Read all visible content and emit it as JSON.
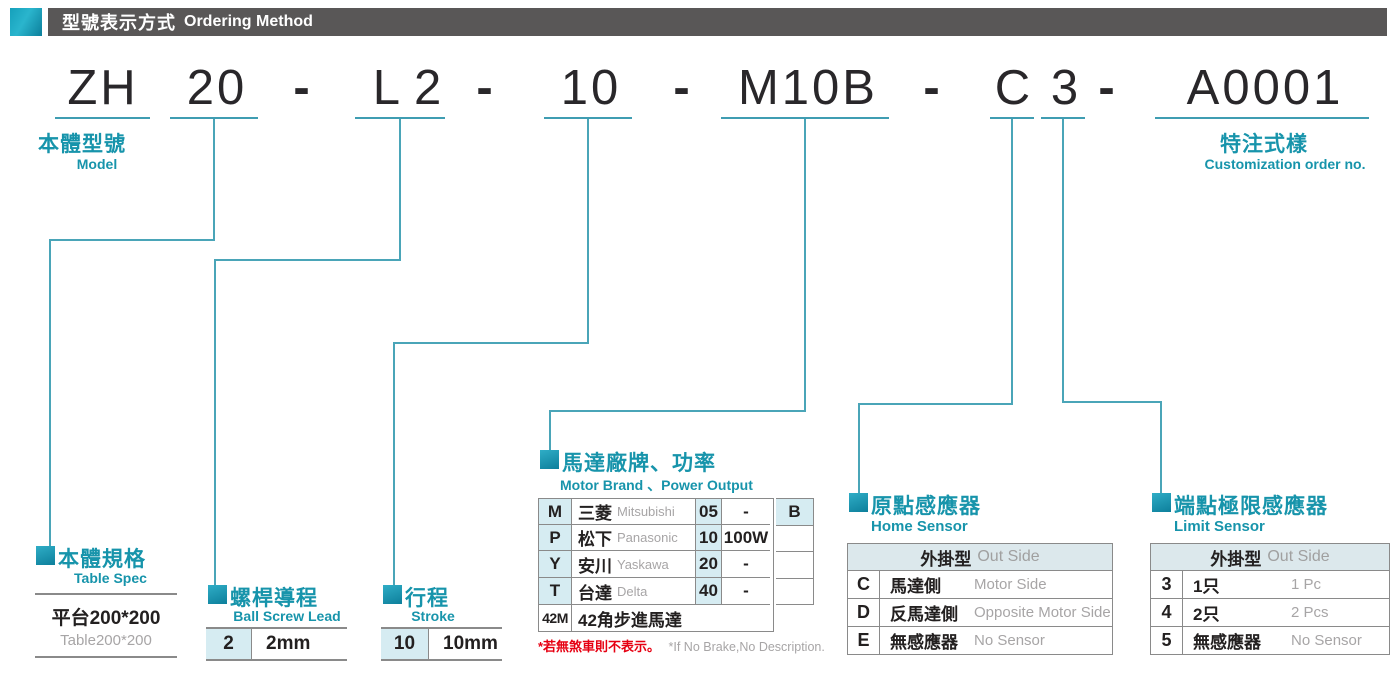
{
  "header": {
    "title_zh": "型號表示方式",
    "title_en": "Ordering Method"
  },
  "model": {
    "parts": [
      "ZH",
      "20",
      "-",
      "L2",
      "-",
      "10",
      "-",
      "M10B",
      "-",
      "C",
      "3",
      "-",
      "A0001"
    ]
  },
  "labels": {
    "model_zh": "本體型號",
    "model_en": "Model",
    "custom_zh": "特注式樣",
    "custom_en": "Customization order no."
  },
  "sections": {
    "table_spec": {
      "title_zh": "本體規格",
      "title_en": "Table Spec",
      "row_zh": "平台200*200",
      "row_en": "Table200*200"
    },
    "ball_screw": {
      "title_zh": "螺桿導程",
      "title_en": "Ball Screw Lead",
      "code": "2",
      "value": "2mm"
    },
    "stroke": {
      "title_zh": "行程",
      "title_en": "Stroke",
      "code": "10",
      "value": "10mm"
    },
    "motor": {
      "title_zh": "馬達廠牌、功率",
      "title_en": "Motor Brand 、Power Output",
      "rows": [
        {
          "code": "M",
          "brand_zh": "三菱",
          "brand_en": "Mitsubishi",
          "power_code": "05",
          "power": "-"
        },
        {
          "code": "P",
          "brand_zh": "松下",
          "brand_en": "Panasonic",
          "power_code": "10",
          "power": "100W"
        },
        {
          "code": "Y",
          "brand_zh": "安川",
          "brand_en": "Yaskawa",
          "power_code": "20",
          "power": "-"
        },
        {
          "code": "T",
          "brand_zh": "台達",
          "brand_en": "Delta",
          "power_code": "40",
          "power": "-"
        }
      ],
      "suffix": "B",
      "stepper": {
        "code": "42M",
        "label": "42角步進馬達"
      },
      "footnote_zh": "*若無煞車則不表示。",
      "footnote_en": "*If No Brake,No Description."
    },
    "home_sensor": {
      "title_zh": "原點感應器",
      "title_en": "Home Sensor",
      "header_zh": "外掛型",
      "header_en": "Out Side",
      "rows": [
        {
          "code": "C",
          "zh": "馬達側",
          "en": "Motor Side"
        },
        {
          "code": "D",
          "zh": "反馬達側",
          "en": "Opposite Motor Side"
        },
        {
          "code": "E",
          "zh": "無感應器",
          "en": "No Sensor"
        }
      ]
    },
    "limit_sensor": {
      "title_zh": "端點極限感應器",
      "title_en": "Limit Sensor",
      "header_zh": "外掛型",
      "header_en": "Out Side",
      "rows": [
        {
          "code": "3",
          "zh": "1只",
          "en": "1 Pc"
        },
        {
          "code": "4",
          "zh": "2只",
          "en": "2 Pcs"
        },
        {
          "code": "5",
          "zh": "無感應器",
          "en": "No Sensor"
        }
      ]
    }
  },
  "colors": {
    "teal": "#1794ab",
    "connector_line": "#4aa5b8",
    "cell_bg": "#d6ecf2",
    "sensor_header_bg": "#dce8ec",
    "header_bar": "#595757",
    "footnote_red": "#e60012"
  }
}
